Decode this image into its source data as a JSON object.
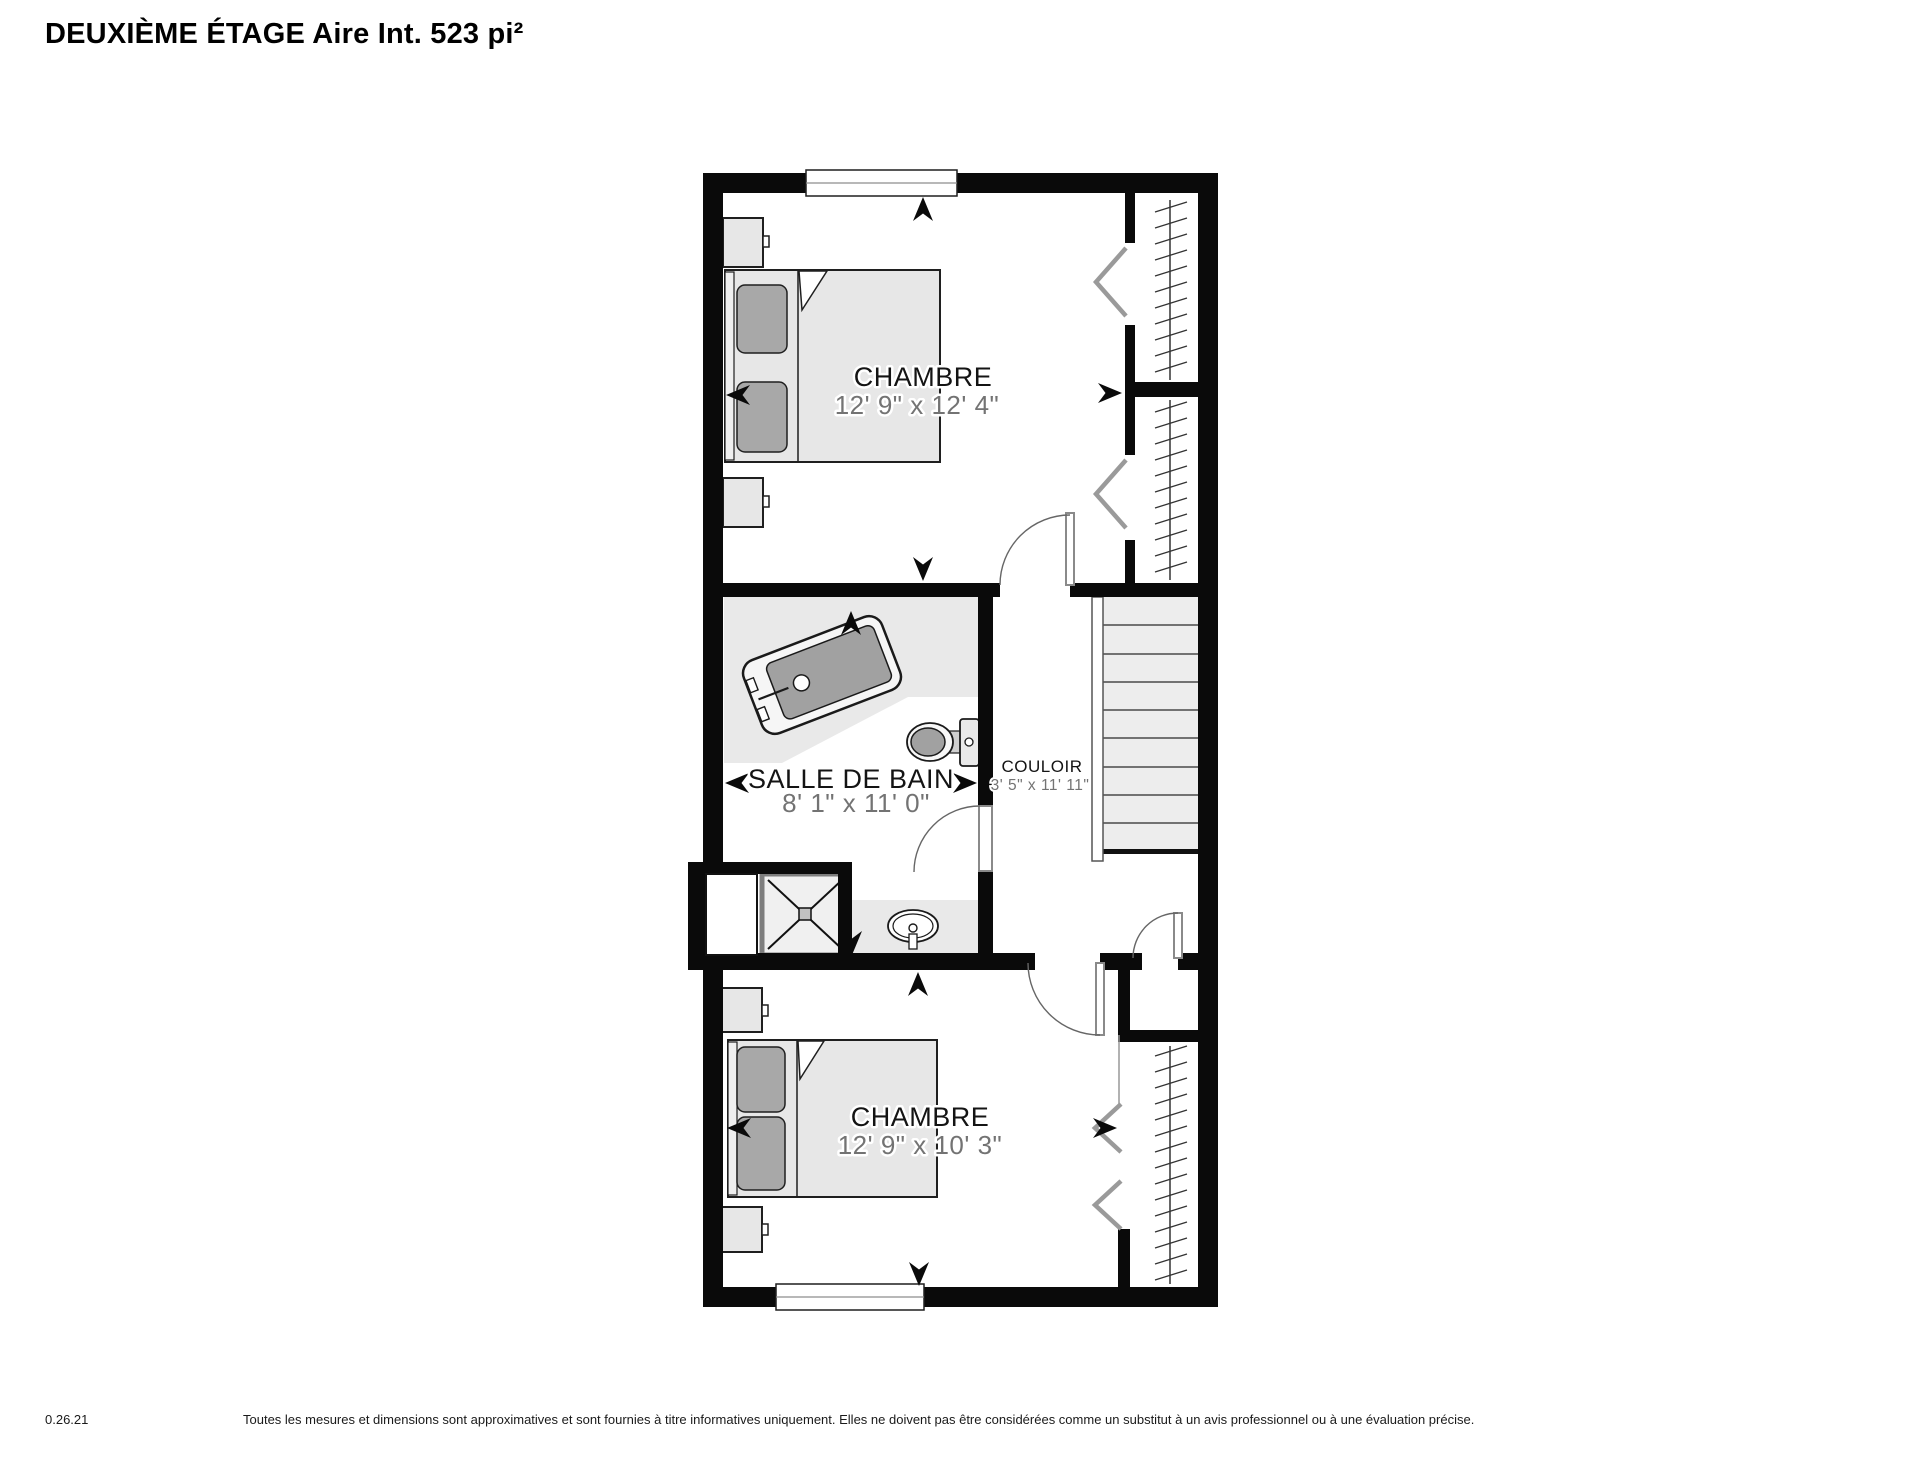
{
  "page": {
    "title": "DEUXIÈME ÉTAGE Aire Int. 523 pi²"
  },
  "rooms": {
    "bedroom_top": {
      "name": "CHAMBRE",
      "dims": "12' 9\" x 12' 4\""
    },
    "bathroom": {
      "name": "SALLE DE BAIN",
      "dims": "8' 1\" x 11' 0\""
    },
    "hallway": {
      "name": "COULOIR",
      "dims": "3' 5\" x 11' 11\""
    },
    "bedroom_bottom": {
      "name": "CHAMBRE",
      "dims": "12' 9\" x 10' 3\""
    }
  },
  "footer": {
    "version": "0.26.21",
    "disclaimer": "Toutes les mesures et dimensions sont approximatives et sont fournies à titre informatives uniquement. Elles ne doivent pas être considérées comme un substitut à un avis professionnel ou à une évaluation précise."
  },
  "colors": {
    "wall": "#0a0a0a",
    "bathroom_floor": "#e9e9e9",
    "furniture_fill": "#e7e7e7",
    "fixture_gray": "#a1a1a1",
    "stair_tread": "#ededed",
    "room_label": "#141414",
    "dimension_text": "#737373"
  }
}
